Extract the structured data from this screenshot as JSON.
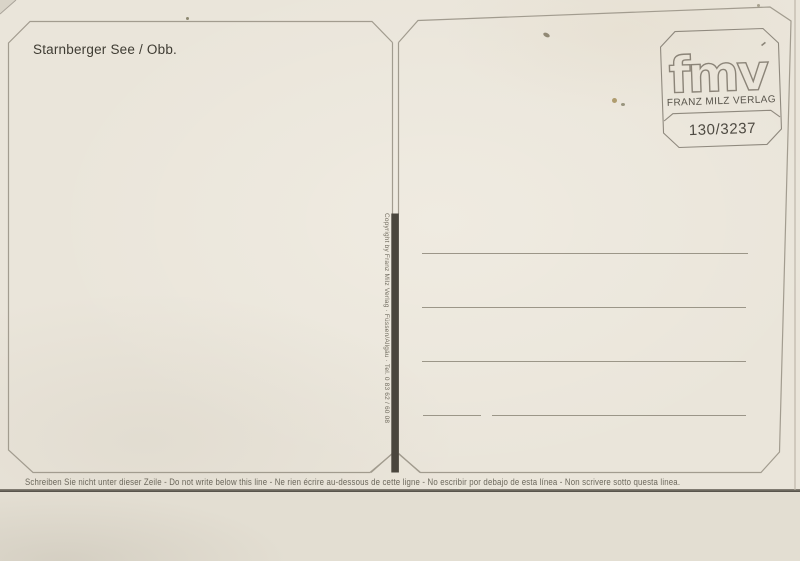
{
  "postcard": {
    "title": "Starnberger See / Obb.",
    "stamp_box": {
      "logo": "fmv",
      "publisher": "FRANZ MILZ VERLAG",
      "order_number": "130/3237"
    },
    "spine": {
      "copyright": "Copyright by Franz Milz Verlag · Füssen/Allgäu · Tel. 0 83 62 / 60 08"
    },
    "address_panel": {
      "blank_lines": 4
    },
    "footer": {
      "notice": "Schreiben Sie nicht unter dieser Zeile - Do not write below this line - Ne rien écrire au-dessous de cette ligne - No escribir por debajo de esta línea - Non scrivere sotto questa linea."
    },
    "colors": {
      "paper": "#eae5da",
      "paper_lower": "#e3ded2",
      "border_line": "#9e988b",
      "divider_bar": "#4a463d",
      "ink": "#3f3c33",
      "muted_ink": "#6f6a5e",
      "edge_line": "#54504a"
    }
  }
}
